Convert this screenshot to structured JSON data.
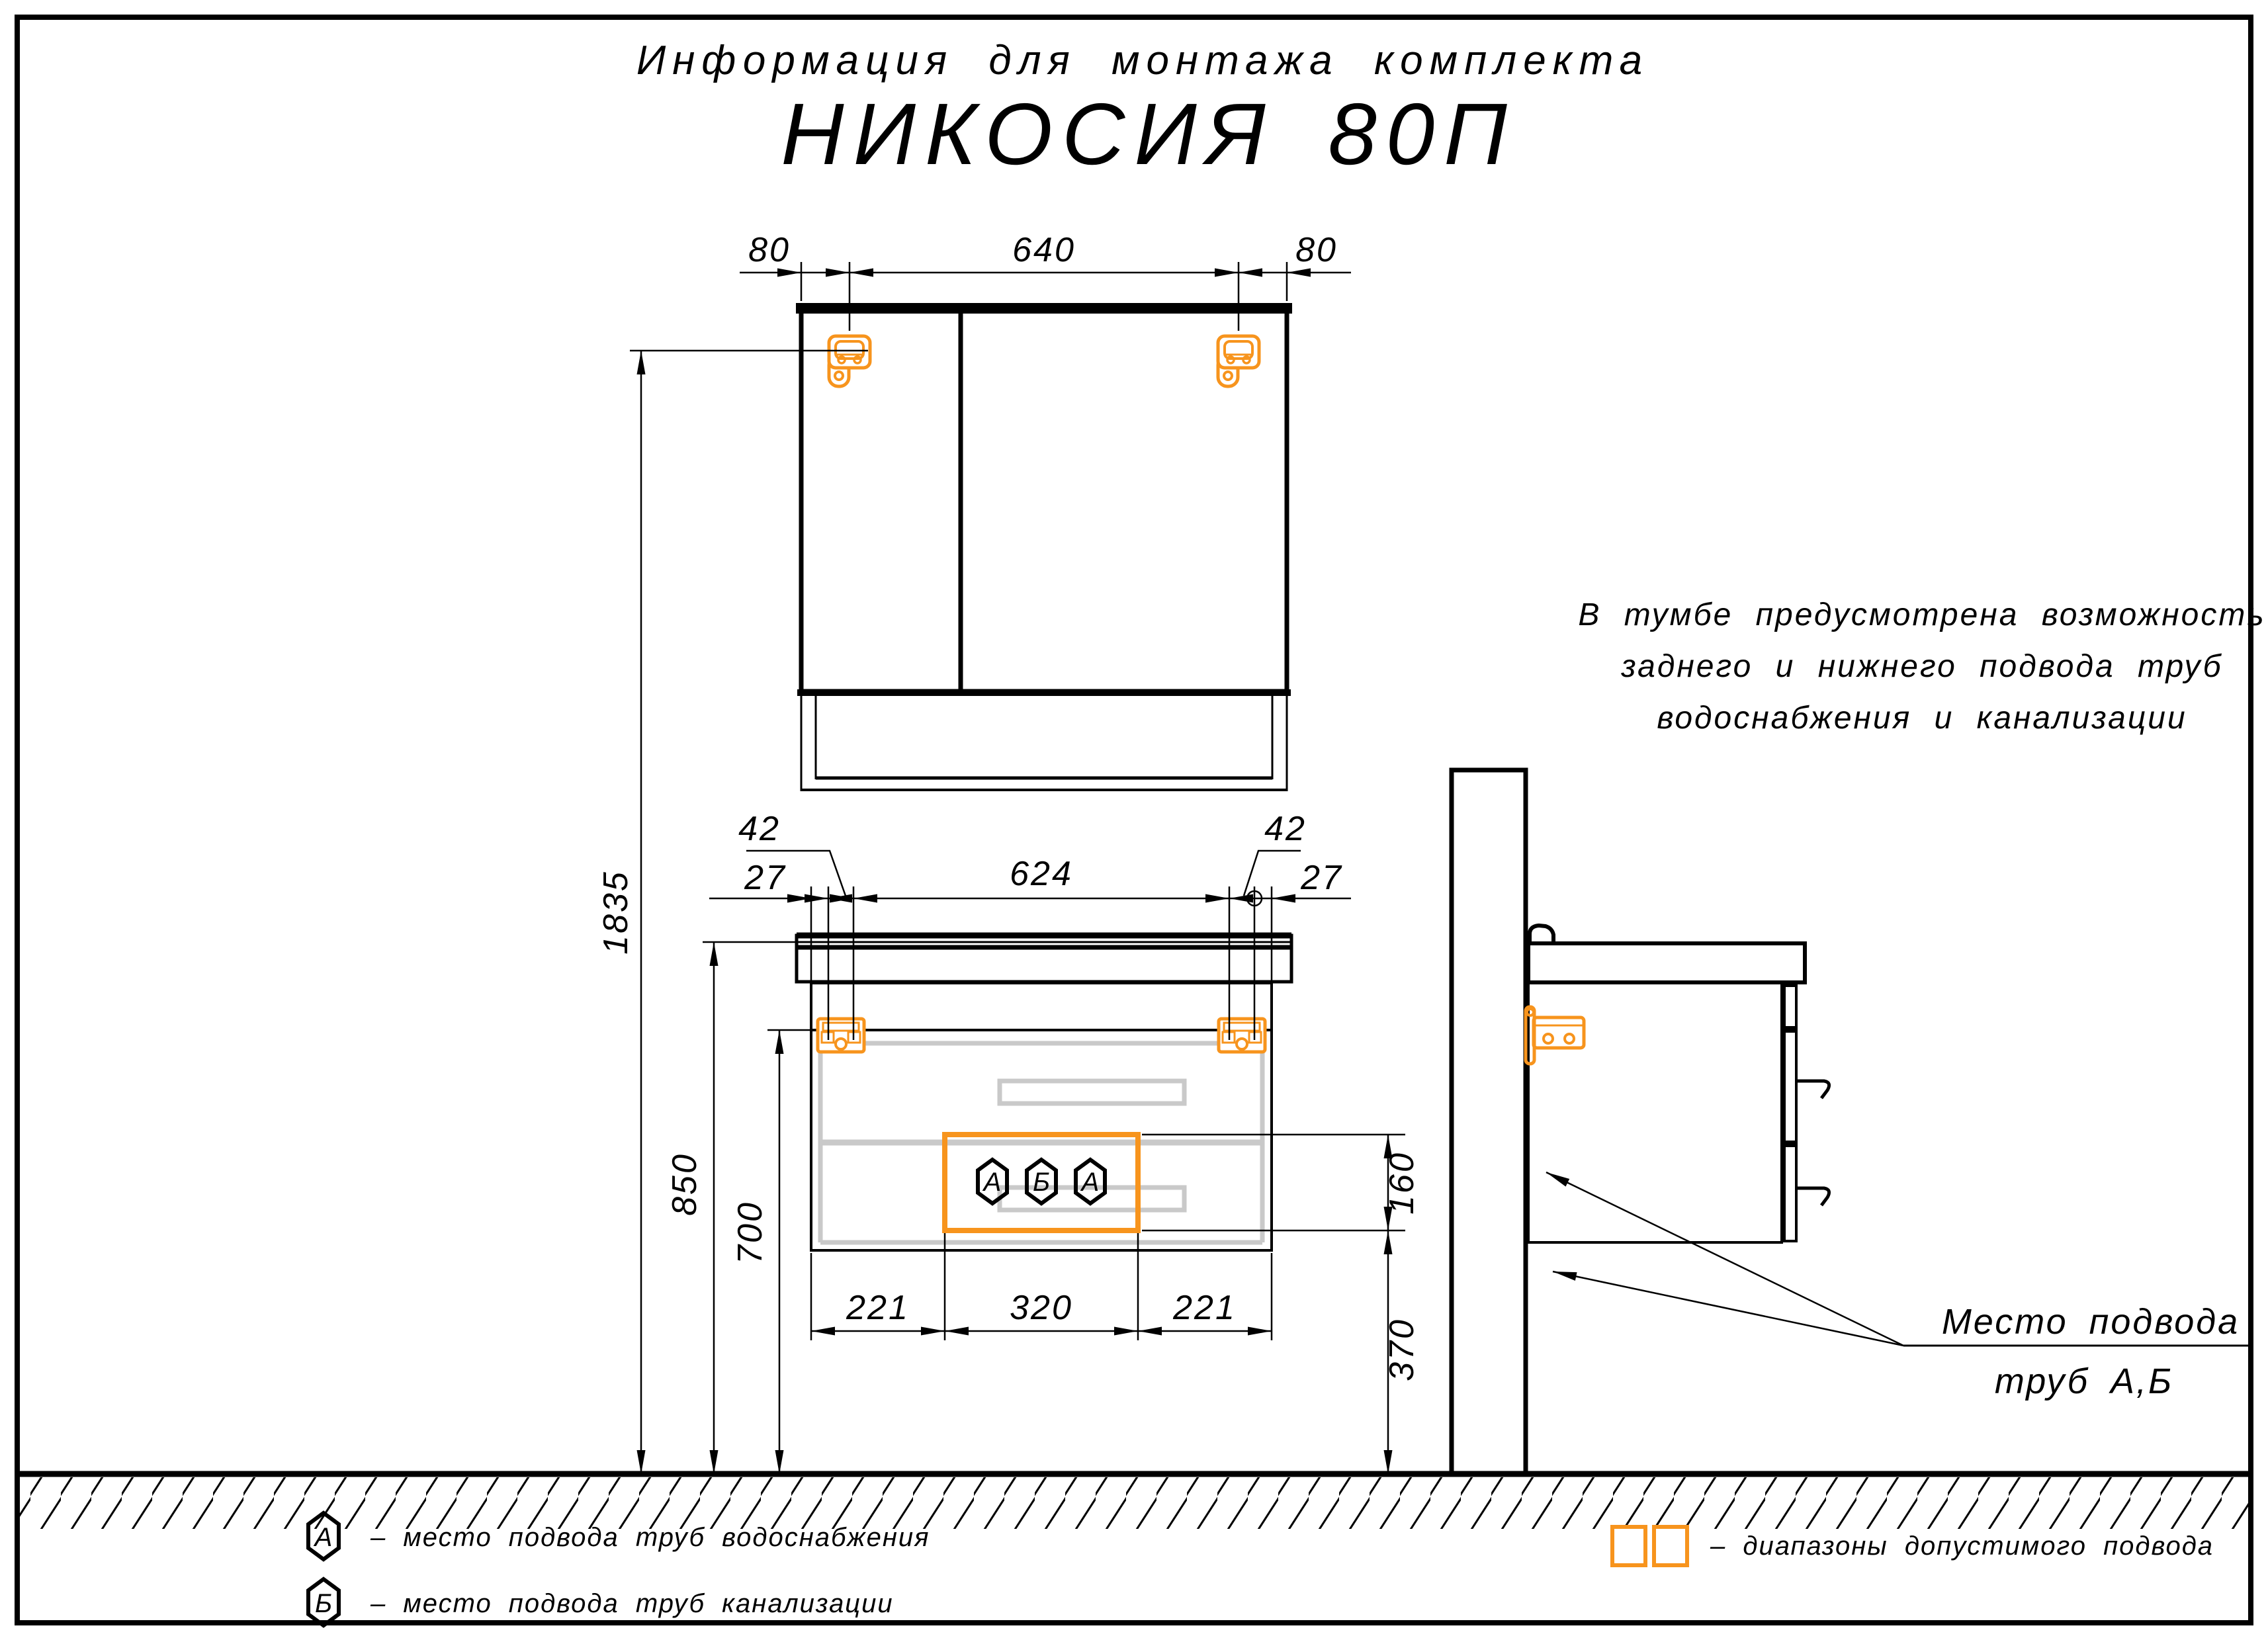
{
  "title": {
    "line1": "Информация для монтажа комплекта",
    "line2": "НИКОСИЯ 80П"
  },
  "colors": {
    "accent_orange": "#F7941D",
    "line_black": "#000000",
    "panel_gray": "#C9C9C9"
  },
  "front_view": {
    "mirror": {
      "dim_left": "80",
      "dim_center": "640",
      "dim_right": "80"
    },
    "vanity_top": {
      "offset_left": "27",
      "hole_left": "42",
      "center": "624",
      "hole_right": "42",
      "offset_right": "27"
    },
    "heights": {
      "total": "1835",
      "to_counter": "850",
      "to_cabinet": "700"
    },
    "bottom": {
      "left": "221",
      "center": "320",
      "right": "221"
    },
    "zone": {
      "height": "160",
      "from_floor": "370",
      "markers": [
        "А",
        "Б",
        "А"
      ]
    }
  },
  "note": {
    "line1": "В тумбе предусмотрена возможность",
    "line2": "заднего и нижнего подвода труб",
    "line3": "водоснабжения и канализации"
  },
  "callout": {
    "line1": "Место подвода",
    "line2": "труб А,Б"
  },
  "legend": {
    "water_marker": "А",
    "water_text": "–  место подвода труб водоснабжения",
    "sewer_marker": "Б",
    "sewer_text": "–  место подвода труб канализации",
    "zones_text": "–  диапазоны допустимого подвода"
  }
}
